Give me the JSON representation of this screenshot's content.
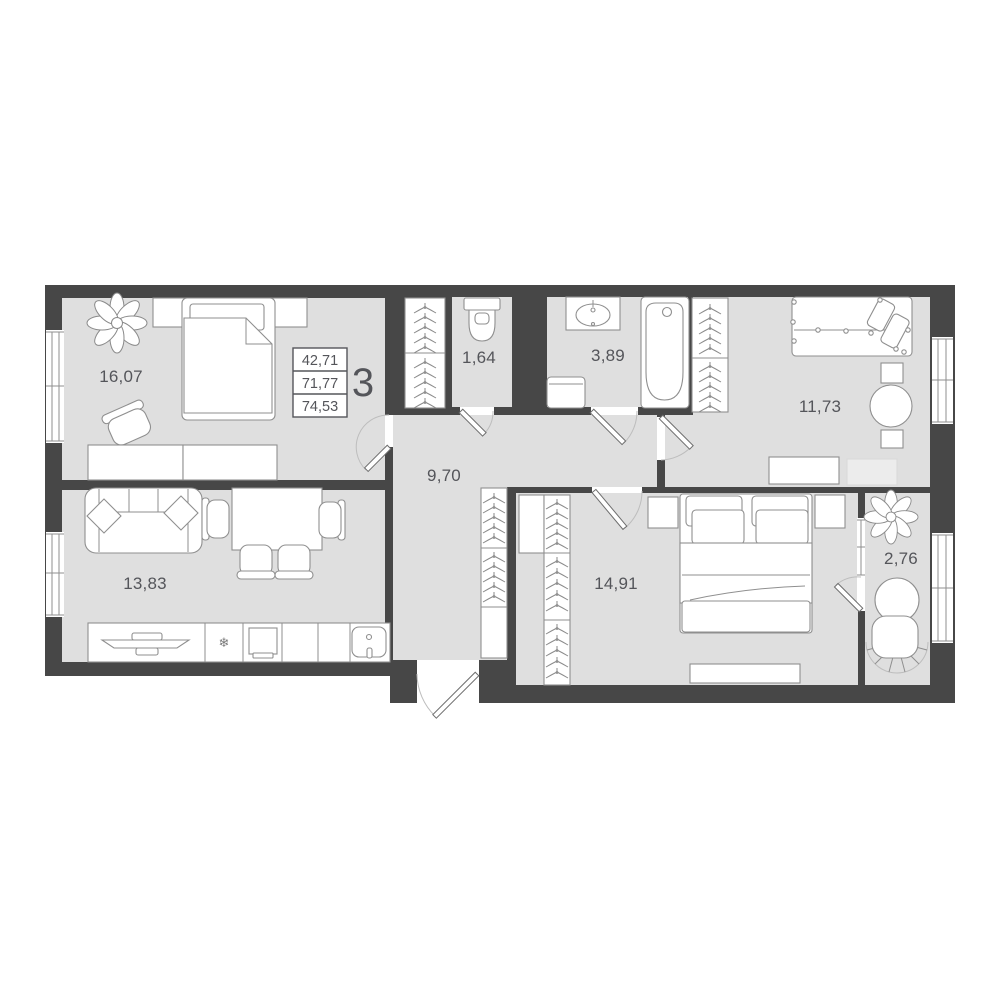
{
  "plan": {
    "title": "apartment-floor-plan",
    "summary": {
      "rooms_count": "3",
      "values": [
        "42,71",
        "71,77",
        "74,53"
      ]
    },
    "rooms": [
      {
        "id": "bedroom-1",
        "area": "16,07"
      },
      {
        "id": "living-kitchen",
        "area": "13,83"
      },
      {
        "id": "hallway",
        "area": "9,70"
      },
      {
        "id": "wc",
        "area": "1,64"
      },
      {
        "id": "bathroom",
        "area": "3,89"
      },
      {
        "id": "bedroom-2",
        "area": "11,73"
      },
      {
        "id": "bedroom-3",
        "area": "14,91"
      },
      {
        "id": "balcony",
        "area": "2,76"
      }
    ],
    "icons": {
      "snowflake": "❄"
    },
    "colors": {
      "wall": "#474747",
      "floor": "#dfdfdf",
      "outline": "#8f8f8f",
      "text": "#54555a",
      "background": "#ffffff"
    }
  }
}
